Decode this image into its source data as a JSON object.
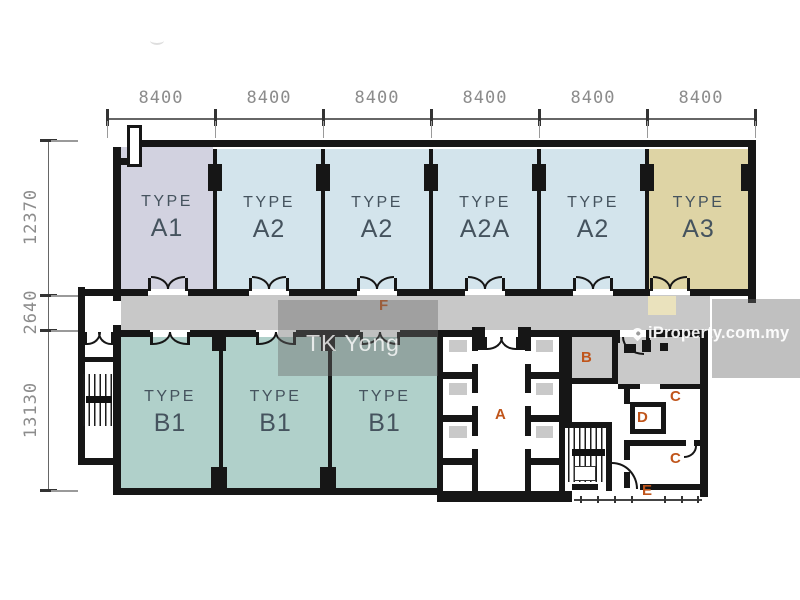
{
  "title": "Floor plan",
  "dims": {
    "top": [
      "8400",
      "8400",
      "8400",
      "8400",
      "8400",
      "8400"
    ],
    "left": [
      "12370",
      "2640",
      "13130"
    ]
  },
  "units": {
    "top": [
      {
        "t": "TYPE",
        "c": "A1"
      },
      {
        "t": "TYPE",
        "c": "A2"
      },
      {
        "t": "TYPE",
        "c": "A2"
      },
      {
        "t": "TYPE",
        "c": "A2A"
      },
      {
        "t": "TYPE",
        "c": "A2"
      },
      {
        "t": "TYPE",
        "c": "A3"
      }
    ],
    "bottom": [
      {
        "t": "TYPE",
        "c": "B1"
      },
      {
        "t": "TYPE",
        "c": "B1"
      },
      {
        "t": "TYPE",
        "c": "B1"
      }
    ]
  },
  "zones": {
    "f": "F",
    "a": "A",
    "b": "B",
    "c1": "C",
    "d": "D",
    "c2": "C",
    "e": "E"
  },
  "watermarks": {
    "tk_yong": "TK Yong",
    "iproperty": "iProperty.com.my"
  },
  "colors": {
    "unit_a1": "#d2d2e0",
    "unit_a2": "#d3e4ec",
    "unit_a3": "#ded4a5",
    "unit_b1": "#b0d0ca",
    "corridor": "#c8c8c8",
    "wall": "#161616",
    "zone_letter": "#c0551b",
    "dim_text": "#8c8c8c"
  }
}
